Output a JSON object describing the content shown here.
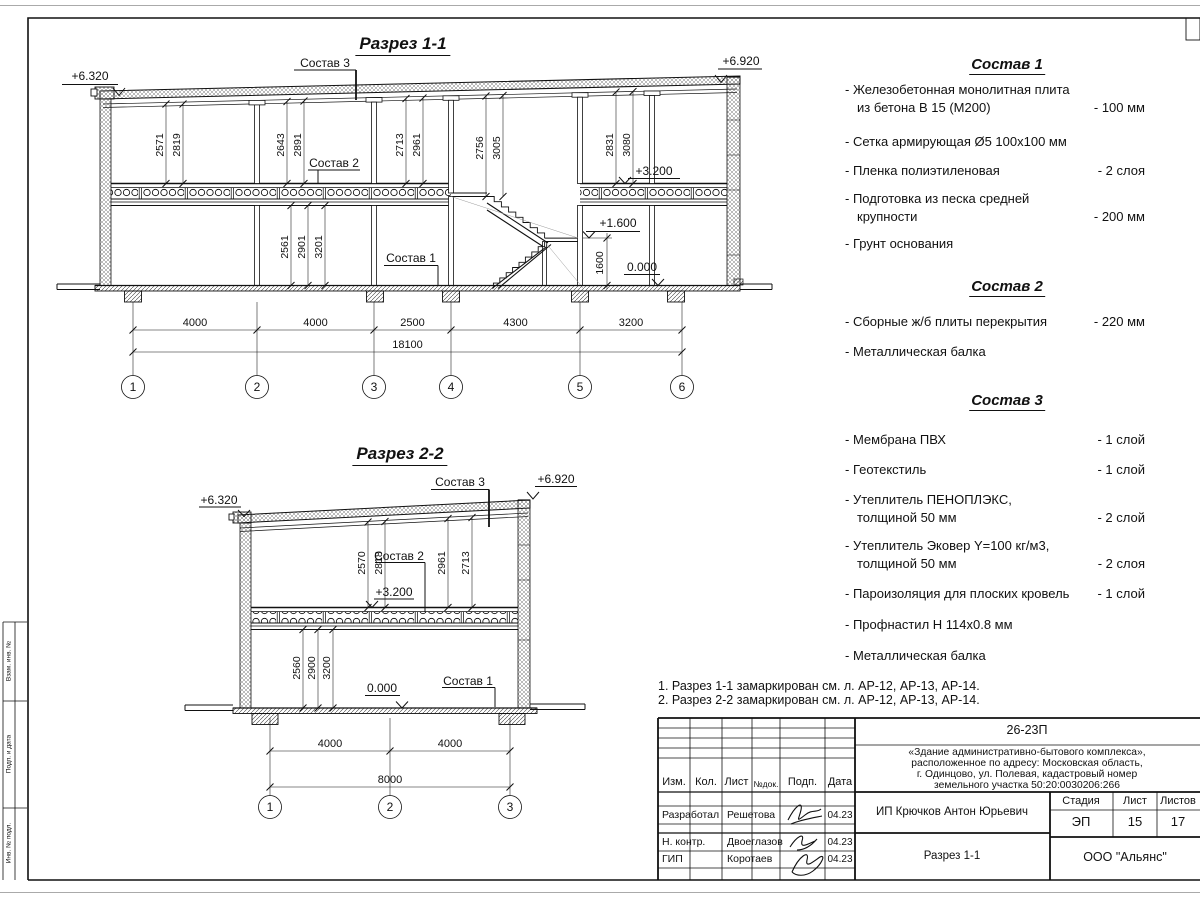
{
  "section1": {
    "title": "Разрез 1-1",
    "leader_sostav1": "Состав 1",
    "leader_sostav2": "Состав 2",
    "leader_sostav3": "Состав 3",
    "level_top_left": "+6.320",
    "level_top_right": "+6.920",
    "level_floor2": "+3.200",
    "level_landing": "+1.600",
    "level_zero": "0.000",
    "dim_landing": "1600",
    "room_dims": [
      "2571",
      "2819",
      "2643",
      "2891",
      "2713",
      "2961",
      "2756",
      "3005",
      "2831",
      "3080"
    ],
    "lower_dims": [
      "2561",
      "2901",
      "3201"
    ],
    "span_dims": [
      "4000",
      "4000",
      "2500",
      "4300",
      "3200"
    ],
    "total_dim": "18100",
    "axes": [
      "1",
      "2",
      "3",
      "4",
      "5",
      "6"
    ]
  },
  "section2": {
    "title": "Разрез 2-2",
    "leader_sostav1": "Состав 1",
    "leader_sostav2": "Состав 2",
    "leader_sostav3": "Состав 3",
    "level_top_left": "+6.320",
    "level_top_right": "+6.920",
    "level_floor2": "+3.200",
    "level_zero": "0.000",
    "room_dims": [
      "2570",
      "2818",
      "2961",
      "2713"
    ],
    "lower_dims": [
      "2560",
      "2900",
      "3200"
    ],
    "span_dims": [
      "4000",
      "4000"
    ],
    "total_dim": "8000",
    "axes": [
      "1",
      "2",
      "3"
    ]
  },
  "specs": [
    {
      "title": "Состав 1",
      "items": [
        {
          "name": "- Железобетонная  монолитная плита",
          "name2": "из бетона В 15 (М200)",
          "value": "- 100 мм"
        },
        {
          "name": "- Сетка армирующая Ø5 100х100 мм",
          "value": ""
        },
        {
          "name": "- Пленка полиэтиленовая",
          "value": "-  2 слоя"
        },
        {
          "name": "- Подготовка из песка средней",
          "name2": "крупности",
          "value": "- 200 мм"
        },
        {
          "name": "- Грунт основания",
          "value": ""
        }
      ]
    },
    {
      "title": "Состав 2",
      "items": [
        {
          "name": "- Сборные ж/б плиты перекрытия",
          "value": "- 220 мм"
        },
        {
          "name": "- Металлическая балка",
          "value": ""
        }
      ]
    },
    {
      "title": "Состав 3",
      "items": [
        {
          "name": "- Мембрана ПВХ",
          "value": "- 1 слой"
        },
        {
          "name": "- Геотекстиль",
          "value": "- 1 слой"
        },
        {
          "name": "- Утеплитель ПЕНОПЛЭКС,",
          "name2": "толщиной 50 мм",
          "value": "- 2 слой"
        },
        {
          "name": "- Утеплитель Эковер Y=100 кг/м3,",
          "name2": "толщиной 50 мм",
          "value": "- 2 слоя"
        },
        {
          "name": "- Пароизоляция для плоских кровель",
          "value": "- 1 слой"
        },
        {
          "name": "- Профнастил Н 114х0.8 мм",
          "value": ""
        },
        {
          "name": "- Металлическая балка",
          "value": ""
        }
      ]
    }
  ],
  "notes": {
    "line1": "1. Разрез 1-1 замаркирован см. л. АР-12, АР-13, АР-14.",
    "line2": "2. Разрез 2-2 замаркирован см. л. АР-12, АР-13, АР-14."
  },
  "titleblock": {
    "doc_number": "26-23П",
    "project_line1": "«Здание административно-бытового комплекса»,",
    "project_line2": "расположенное по адресу: Московская область,",
    "project_line3": "г. Одинцово, ул. Полевая, кадастровый номер",
    "project_line4": "земельного участка 50:20:0030206:266",
    "col_izm": "Изм.",
    "col_kol": "Кол.",
    "col_list": "Лист",
    "col_doc": "№док.",
    "col_podp": "Подп.",
    "col_data": "Дата",
    "row1_role": "Разработал",
    "row1_name": "Решетова",
    "row1_date": "04.23",
    "row2_role": "Н. контр.",
    "row2_name": "Двоеглазов",
    "row2_date": "04.23",
    "row3_role": "ГИП",
    "row3_name": "Коротаев",
    "row3_date": "04.23",
    "client": "ИП Крючков Антон Юрьевич",
    "drawing_title": "Разрез 1-1",
    "stage_label": "Стадия",
    "list_label": "Лист",
    "listov_label": "Листов",
    "stage": "ЭП",
    "list": "15",
    "listov": "17",
    "company": "ООО \"Альянс\""
  },
  "frame": {
    "left_stamp_top": "Взам. инв. №",
    "left_stamp_mid": "Подп. и дата",
    "left_stamp_bottom": "Инв. № подл."
  }
}
